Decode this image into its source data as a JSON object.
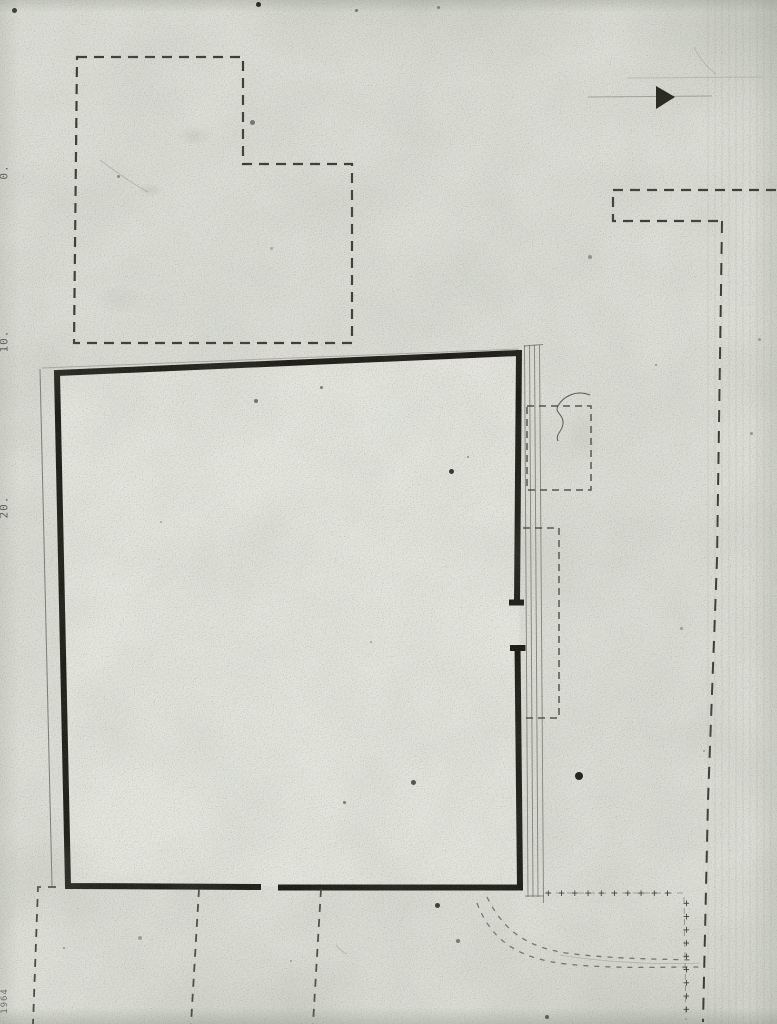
{
  "title": "Scanned architectural site plan",
  "colors": {
    "paper": "#dee0d8",
    "paper_inner": "#e7e9e1",
    "ink_heavy": "#1b1b14",
    "ink_dashed": "#3a3a32",
    "ink_thin": "#70706a",
    "curve_ink": "#5a5a52",
    "label_ink": "#4c4c46"
  },
  "labels": {
    "scale_0": "0.",
    "scale_10": "10.",
    "scale_20": "20.",
    "year": "1964"
  },
  "marks": {
    "plus_row": "+ + + + + + + + + +",
    "plus_col": "+ + + + + + + + +"
  },
  "artifacts": {
    "specks": [
      [
        12,
        8,
        5,
        0.8
      ],
      [
        256,
        2,
        5,
        0.9
      ],
      [
        355,
        9,
        3,
        0.5
      ],
      [
        437,
        6,
        3,
        0.4
      ],
      [
        250,
        120,
        5,
        0.5
      ],
      [
        117,
        175,
        3,
        0.4
      ],
      [
        588,
        255,
        4,
        0.35
      ],
      [
        270,
        247,
        3,
        0.25
      ],
      [
        254,
        399,
        4,
        0.55
      ],
      [
        320,
        386,
        3,
        0.5
      ],
      [
        449,
        469,
        5,
        0.85
      ],
      [
        467,
        456,
        2,
        0.4
      ],
      [
        758,
        338,
        3,
        0.3
      ],
      [
        750,
        432,
        3,
        0.35
      ],
      [
        655,
        364,
        2,
        0.4
      ],
      [
        160,
        521,
        2,
        0.3
      ],
      [
        370,
        641,
        2,
        0.3
      ],
      [
        680,
        627,
        3,
        0.3
      ],
      [
        703,
        750,
        2,
        0.3
      ],
      [
        411,
        780,
        5,
        0.7
      ],
      [
        343,
        801,
        3,
        0.5
      ],
      [
        575,
        772,
        8,
        0.95
      ],
      [
        435,
        903,
        5,
        0.8
      ],
      [
        456,
        939,
        4,
        0.5
      ],
      [
        138,
        936,
        4,
        0.3
      ],
      [
        63,
        947,
        2,
        0.4
      ],
      [
        545,
        1015,
        4,
        0.6
      ],
      [
        290,
        960,
        2,
        0.3
      ]
    ]
  }
}
